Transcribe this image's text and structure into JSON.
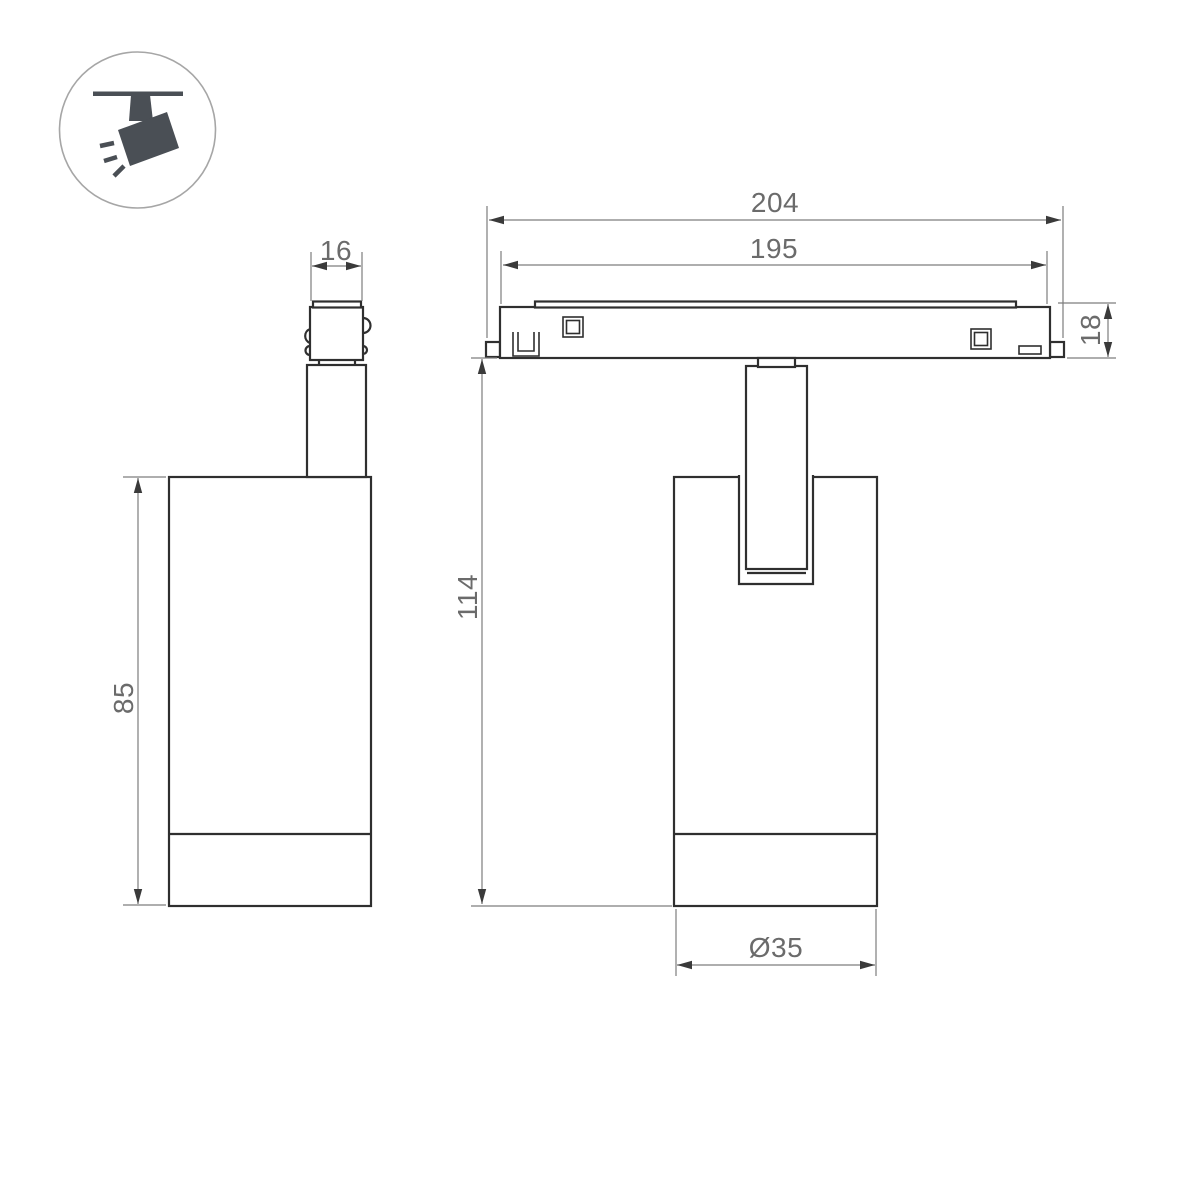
{
  "drawing": {
    "icon": {
      "label": "ceiling-track-spotlight"
    },
    "dimensions": {
      "adapter_width": "16",
      "body_height": "85",
      "track_length_overall": "204",
      "track_length_inner": "195",
      "track_height": "18",
      "overall_height": "114",
      "body_diameter": "Ø35"
    },
    "colors": {
      "object_line": "#2f2f2f",
      "dimension_line": "#7d7d7d",
      "arrowhead": "#3a3a3a",
      "dimension_text": "#6b6b6b",
      "icon_fill": "#4a4f55",
      "icon_circle_stroke": "#a6a6a6",
      "background": "#ffffff"
    }
  }
}
